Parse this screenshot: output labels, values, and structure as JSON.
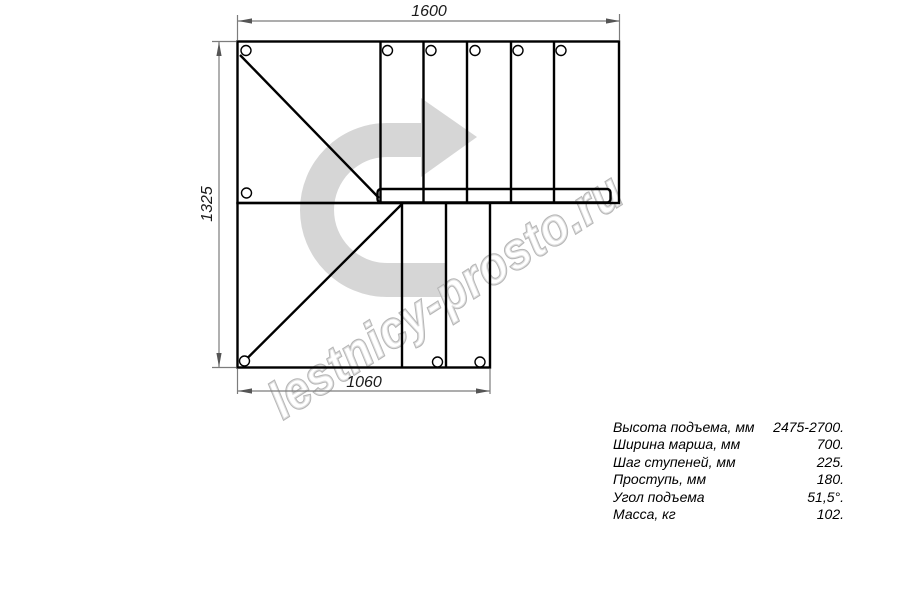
{
  "drawing": {
    "watermark": "lestnicy-prosto.ru",
    "dimensions": {
      "top_width_mm": "1600",
      "left_height_mm": "1325",
      "bottom_width_mm": "1060"
    }
  },
  "specs": {
    "rows": [
      {
        "label": "Высота подъема, мм",
        "value": "2475-2700."
      },
      {
        "label": "Ширина марша, мм",
        "value": "700."
      },
      {
        "label": "Шаг ступеней, мм",
        "value": "225."
      },
      {
        "label": "Проступь, мм",
        "value": "180."
      },
      {
        "label": "Угол подъема",
        "value": "51,5°."
      },
      {
        "label": "Масса, кг",
        "value": "102."
      }
    ]
  },
  "colors": {
    "line": "#000000",
    "dimension": "#7c7c7c",
    "arrow_head_fill": "#555555",
    "turn_arrow_fill": "#d6d6d6",
    "watermark_stroke": "#b6b6b6"
  }
}
